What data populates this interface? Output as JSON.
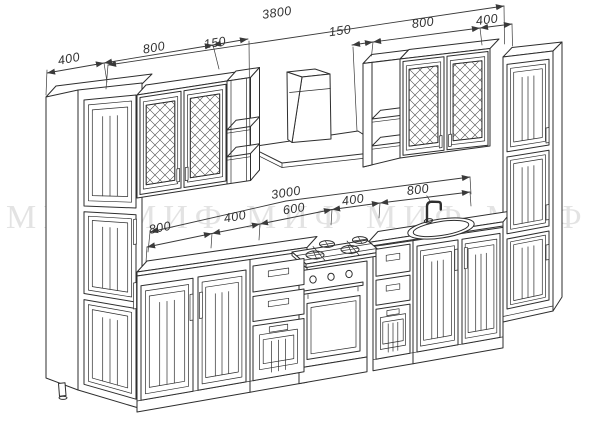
{
  "watermark": {
    "text": "МИФ"
  },
  "dims": {
    "overall": "3800",
    "top_left": [
      "400",
      "800",
      "150"
    ],
    "top_right": [
      "150",
      "800",
      "400"
    ],
    "run_total": "3000",
    "run_segments": [
      "800",
      "400",
      "600",
      "400",
      "800"
    ]
  },
  "colors": {
    "line": "#2e2e2e",
    "dim_text": "#333333",
    "background": "#ffffff"
  }
}
